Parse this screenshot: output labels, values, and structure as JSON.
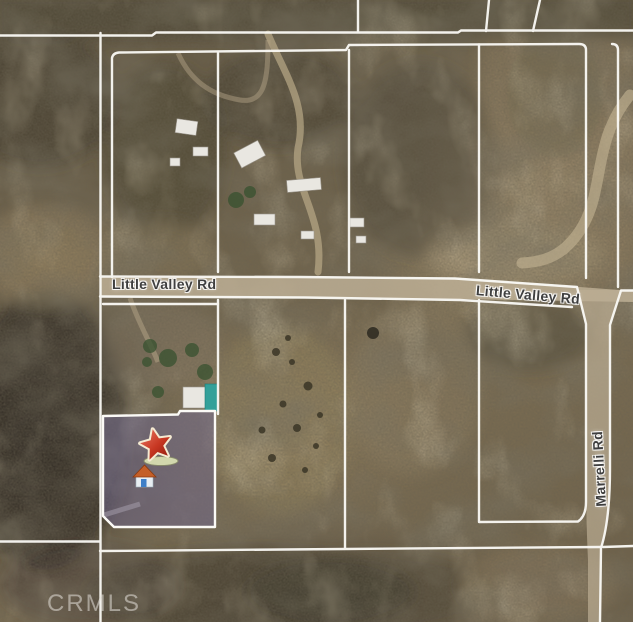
{
  "map": {
    "road_labels": [
      {
        "id": "little-valley-rd-west",
        "text": "Little Valley Rd"
      },
      {
        "id": "little-valley-rd-east",
        "text": "Little Valley Rd"
      },
      {
        "id": "marrelli-rd",
        "text": "Marrelli Rd"
      }
    ],
    "watermark": "CRMLS",
    "marker": {
      "primary_icon": "star-marker-icon",
      "secondary_icon": "house-icon"
    }
  },
  "theme": {
    "parcel-line": "#fbfaf6",
    "road-label": "#3f3f3f",
    "road-surface": "#bcae94",
    "highlight-purple": "#6f6890",
    "star-red": "#c0281a",
    "star-outline": "#f4ead2",
    "watermark-color": "#e4e0da"
  }
}
